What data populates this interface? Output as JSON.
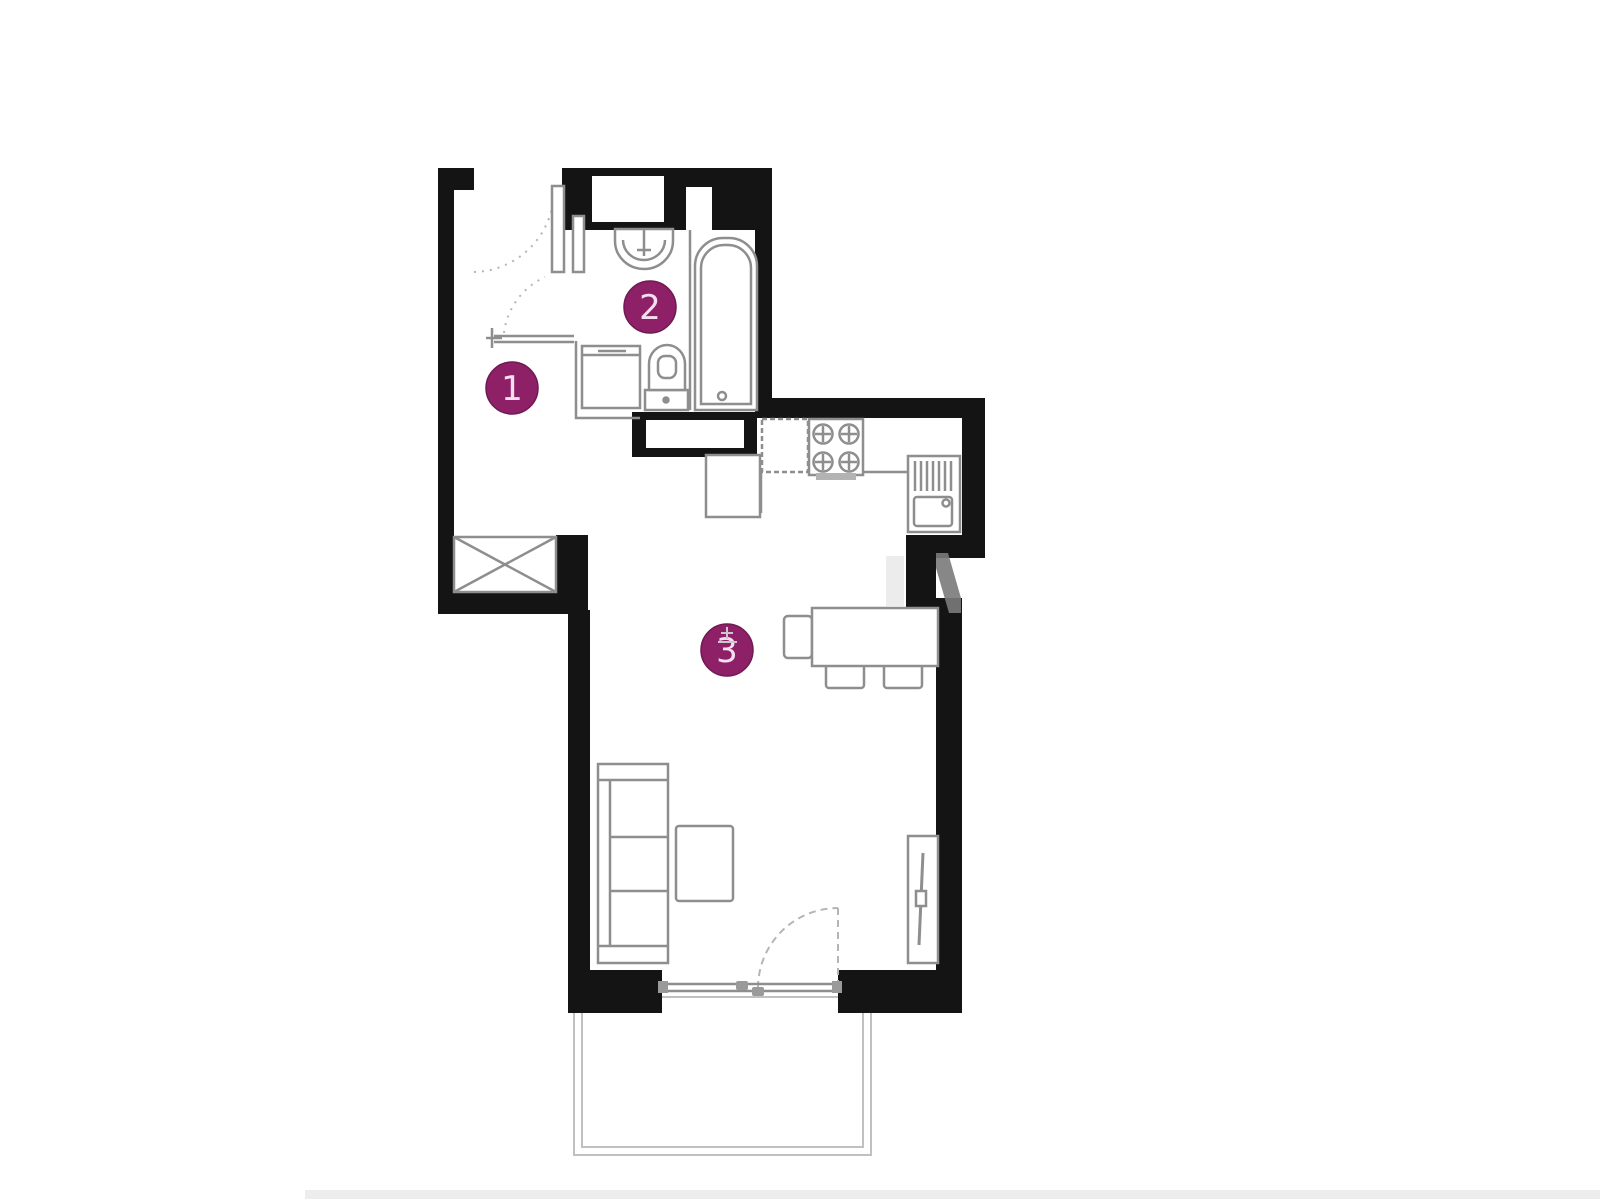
{
  "page": {
    "background": "#ffffff",
    "bottom_strip_color": "#ededed"
  },
  "colors": {
    "wall": "#141414",
    "furniture_line": "#8e8e8e",
    "light_line": "#b5b5b5",
    "balcony_line": "#c0c0c0",
    "stove_bar": "#b3b3b3",
    "hardware": "#9a9a9a",
    "marker_fill": "#8e2068",
    "marker_stroke": "#6f1a53",
    "marker_text": "#f4dfee",
    "level_symbol": "#c9c9c9",
    "watermark_dark": "#7a7a7a",
    "watermark_light": "#e0e0e0"
  },
  "markers": [
    {
      "label": "1"
    },
    {
      "label": "2"
    },
    {
      "label": "3"
    }
  ],
  "fixtures": [
    "entrance-door",
    "bathroom-door",
    "coat-rail",
    "wardrobe-shaft-box",
    "washbasin",
    "toilet",
    "washing-machine",
    "bathtub",
    "fridge",
    "stove",
    "kitchen-cabinet",
    "kitchen-sink",
    "dining-table",
    "chair",
    "sofa",
    "coffee-table",
    "tv-stand",
    "balcony-door",
    "balcony"
  ]
}
